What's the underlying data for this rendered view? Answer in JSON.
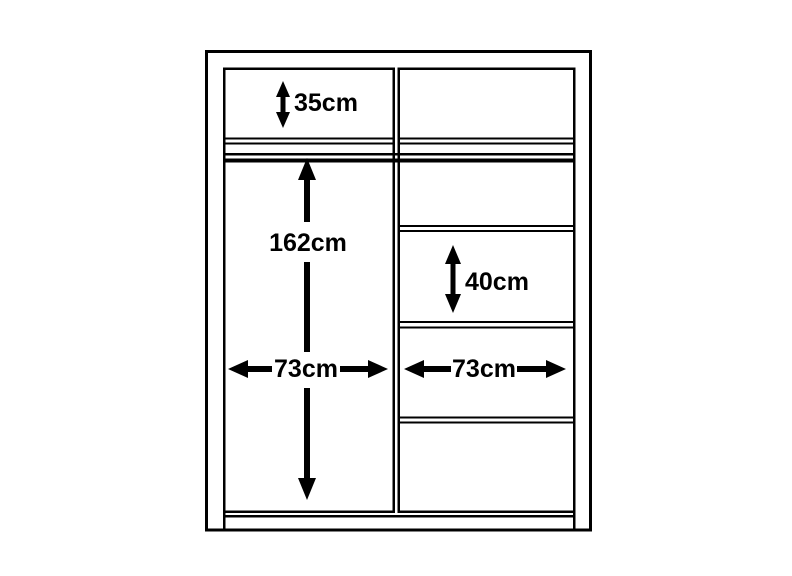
{
  "diagram": {
    "kind": "wardrobe-dimension-diagram",
    "background_color": "#ffffff",
    "line_color": "#000000",
    "units": "cm",
    "labels": {
      "top_section_height": "35cm",
      "hanging_section_height": "162cm",
      "left_section_width": "73cm",
      "middle_shelf_height": "40cm",
      "right_section_width": "73cm"
    },
    "measurements": [
      {
        "part": "top-compartment-height",
        "label": "35cm",
        "cm": 35
      },
      {
        "part": "left-hanging-space-height",
        "label": "162cm",
        "cm": 162
      },
      {
        "part": "left-section-width",
        "label": "73cm",
        "cm": 73
      },
      {
        "part": "right-shelf-compartment-height",
        "label": "40cm",
        "cm": 40
      },
      {
        "part": "right-section-width",
        "label": "73cm",
        "cm": 73
      }
    ]
  }
}
